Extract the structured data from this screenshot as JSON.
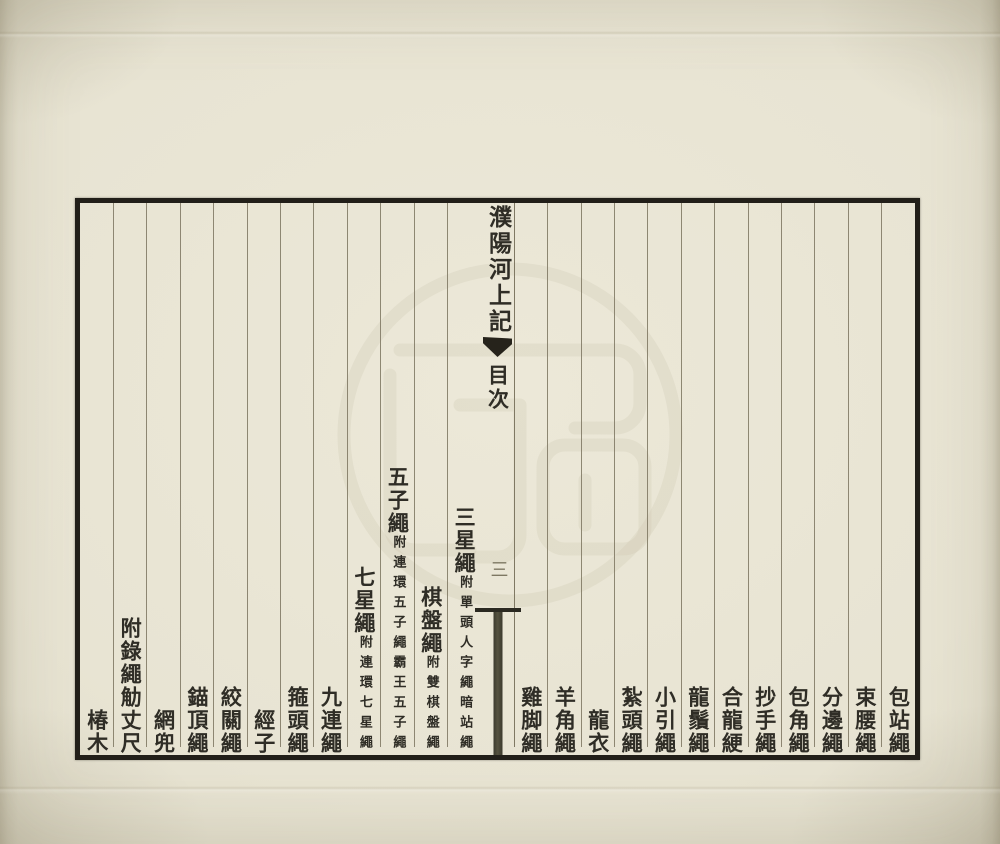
{
  "document": {
    "center": {
      "title": "濮陽河上記",
      "section_label": "目次",
      "page_number": "三"
    },
    "entries": [
      {
        "main": "包站繩",
        "sub": ""
      },
      {
        "main": "束腰繩",
        "sub": ""
      },
      {
        "main": "分邊繩",
        "sub": ""
      },
      {
        "main": "包角繩",
        "sub": ""
      },
      {
        "main": "抄手繩",
        "sub": ""
      },
      {
        "main": "合龍綆",
        "sub": ""
      },
      {
        "main": "龍鬚繩",
        "sub": ""
      },
      {
        "main": "小引繩",
        "sub": ""
      },
      {
        "main": "紮頭繩",
        "sub": ""
      },
      {
        "main": "龍衣",
        "sub": ""
      },
      {
        "main": "羊角繩",
        "sub": ""
      },
      {
        "main": "雞脚繩",
        "sub": ""
      },
      {
        "center": true
      },
      {
        "main": "三星繩",
        "sub": "附單頭人字繩暗站繩"
      },
      {
        "main": "棋盤繩",
        "sub": "附雙棋盤繩"
      },
      {
        "main": "五子繩",
        "sub": "附連環五子繩霸王五子繩"
      },
      {
        "main": "七星繩",
        "sub": "附連環七星繩"
      },
      {
        "main": "九連繩",
        "sub": ""
      },
      {
        "main": "箍頭繩",
        "sub": ""
      },
      {
        "main": "經子",
        "sub": ""
      },
      {
        "main": "絞關繩",
        "sub": ""
      },
      {
        "main": "錨頂繩",
        "sub": ""
      },
      {
        "main": "網兜",
        "sub": ""
      },
      {
        "main": "附錄繩觔丈尺",
        "sub": ""
      },
      {
        "main": "椿木",
        "sub": ""
      }
    ]
  },
  "colors": {
    "paper": "#e8e4d3",
    "frame_ink": "#221f19",
    "rule_line": "#7d7660",
    "text_ink": "#2f2d26",
    "watermark": "#b3ac8e"
  }
}
